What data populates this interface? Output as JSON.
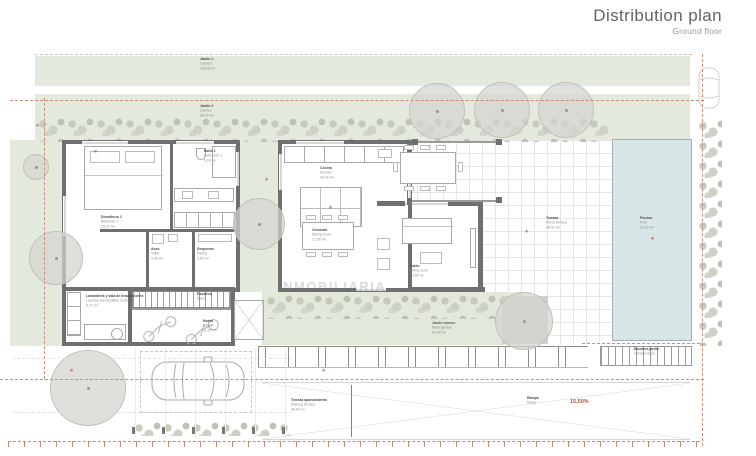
{
  "header": {
    "title": "Distribution plan",
    "subtitle": "Ground floor"
  },
  "watermark": "INMOBILIARIA",
  "icons": {
    "plant_marker": "✳"
  },
  "colors": {
    "wall": "#6f6f6f",
    "garden": "#e4e9de",
    "pool": "#d9e6e8",
    "boundary_dash": "#cb8d77",
    "accent_red": "#b5503a",
    "hedge": "#c7cabf"
  },
  "rooms": {
    "garden_a": {
      "name": "Jardín 1",
      "sub": "Garden",
      "area": "118,00 m²"
    },
    "garden_b": {
      "name": "Jardín 2",
      "sub": "Garden",
      "area": "96,00 m²"
    },
    "bedroom": {
      "name": "Dormitorio 1",
      "sub": "Bedroom 1",
      "area": "15,20 m²"
    },
    "bathroom": {
      "name": "Baño 1",
      "sub": "Bathroom 1",
      "area": "6,10 m²"
    },
    "toilet": {
      "name": "Aseo",
      "sub": "Toilet",
      "area": "2,90 m²"
    },
    "pantry": {
      "name": "Despensa",
      "sub": "Pantry",
      "area": "3,60 m²"
    },
    "kitchen": {
      "name": "Cocina",
      "sub": "Kitchen",
      "area": "16,40 m²"
    },
    "dining": {
      "name": "Comedor",
      "sub": "Dining room",
      "area": "17,30 m²"
    },
    "living": {
      "name": "Salón",
      "sub": "Living room",
      "area": "24,60 m²"
    },
    "terrace": {
      "name": "Terraza",
      "sub": "Porch terrace",
      "area": "48,50 m²"
    },
    "pool": {
      "name": "Piscina",
      "sub": "Pool",
      "area": "32,00 m²"
    },
    "laundry": {
      "name": "Lavandería y sala de instalaciones",
      "sub": "Laundry and facilities room",
      "area": "8,70 m²"
    },
    "stairs": {
      "name": "Escalera",
      "sub": "Stairs"
    },
    "bikes": {
      "name": "Motos",
      "sub": "Bikes",
      "area": "11,20 m²"
    },
    "garden_back": {
      "name": "Jardín trasero",
      "sub": "Back garden",
      "area": "42,00 m²"
    },
    "parking": {
      "name": "Terraza aparcamiento",
      "sub": "Parking terrace",
      "area": "80,00 m²"
    },
    "ramp": {
      "name": "Rampa",
      "sub": "Ramp",
      "slope": "15,50%"
    },
    "steps": {
      "name": "Escalera jardín",
      "sub": "Garden steps"
    }
  }
}
